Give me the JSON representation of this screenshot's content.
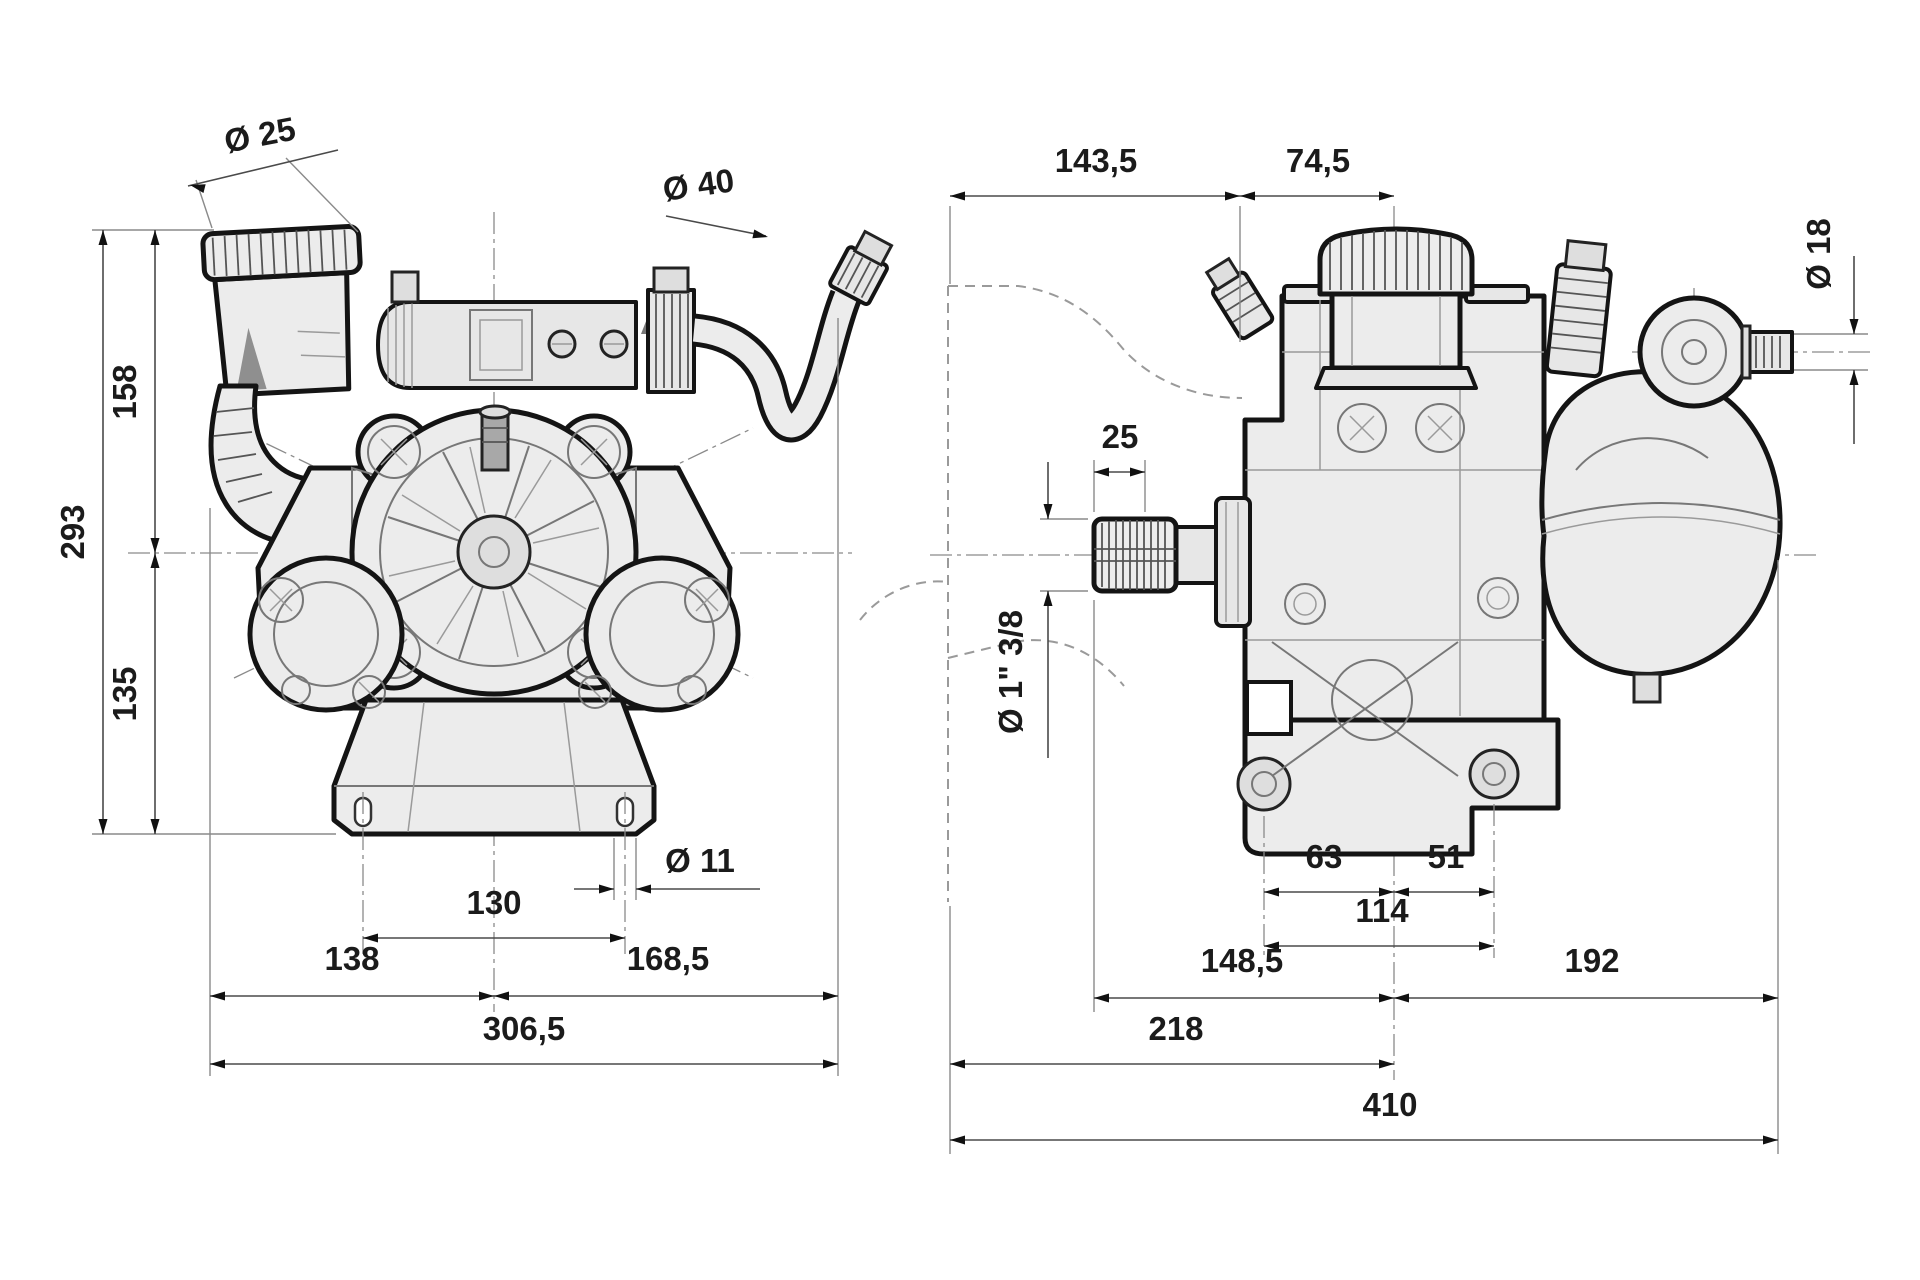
{
  "drawing": {
    "type": "pump-dimensional-drawing",
    "colors": {
      "outline": "#141414",
      "body_fill": "#ececec",
      "background": "#ffffff",
      "dimension_lines": "#4a4a4a"
    },
    "front_view": {
      "dims": {
        "dia_suction_port": "Ø 25",
        "dia_outlet_hose": "Ø 40",
        "height_center_to_top": "158",
        "height_total": "293",
        "height_base_to_center": "135",
        "dia_mounting_slot": "Ø 11",
        "mounting_hole_spacing": "130",
        "width_left_of_center": "138",
        "width_right_of_center": "168,5",
        "width_total": "306,5"
      }
    },
    "side_view": {
      "dims": {
        "depth_ref_to_body": "143,5",
        "depth_body_to_tank_center": "74,5",
        "dia_outlet_nipple": "Ø 18",
        "shaft_spline_length": "25",
        "shaft_size": "Ø 1\" 3/8",
        "foot_hole_left_to_center": "63",
        "foot_center_to_hole_right": "51",
        "foot_hole_spacing": "114",
        "shaft_end_to_center": "148,5",
        "center_to_right_end": "192",
        "ref_to_center": "218",
        "depth_total": "410"
      }
    }
  }
}
